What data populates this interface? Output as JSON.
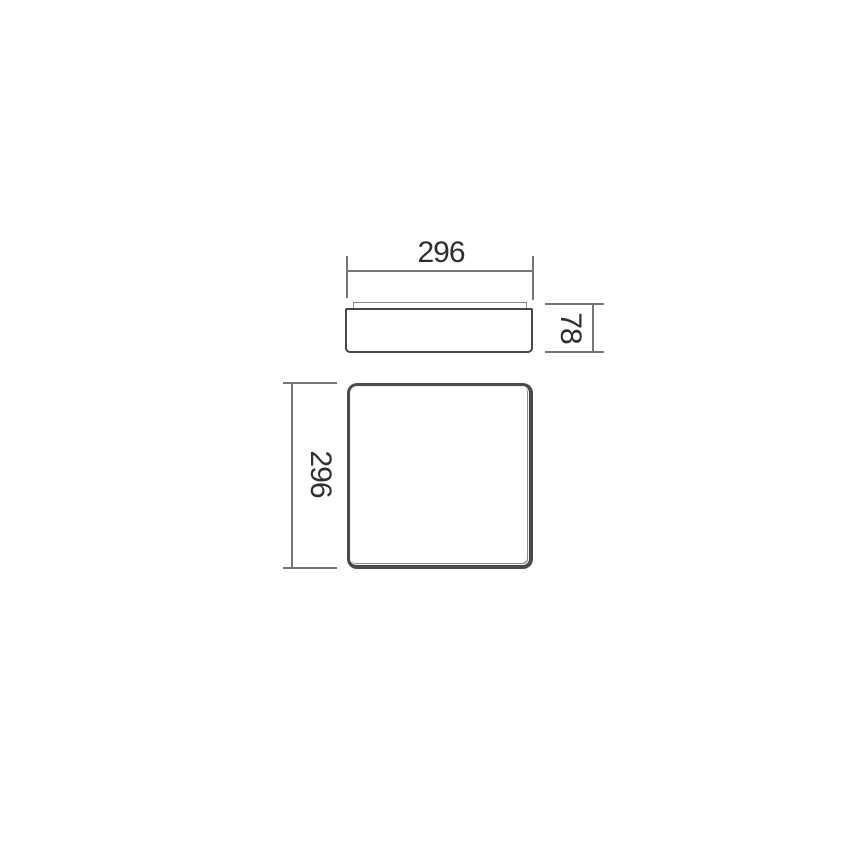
{
  "drawing": {
    "labels": {
      "side_width": "296",
      "side_height": "78",
      "plan_size": "296"
    },
    "colors": {
      "background": "#ffffff",
      "dimension_line": "#767676",
      "part_edge": "#474747",
      "label_text": "#2f2f2f"
    }
  }
}
